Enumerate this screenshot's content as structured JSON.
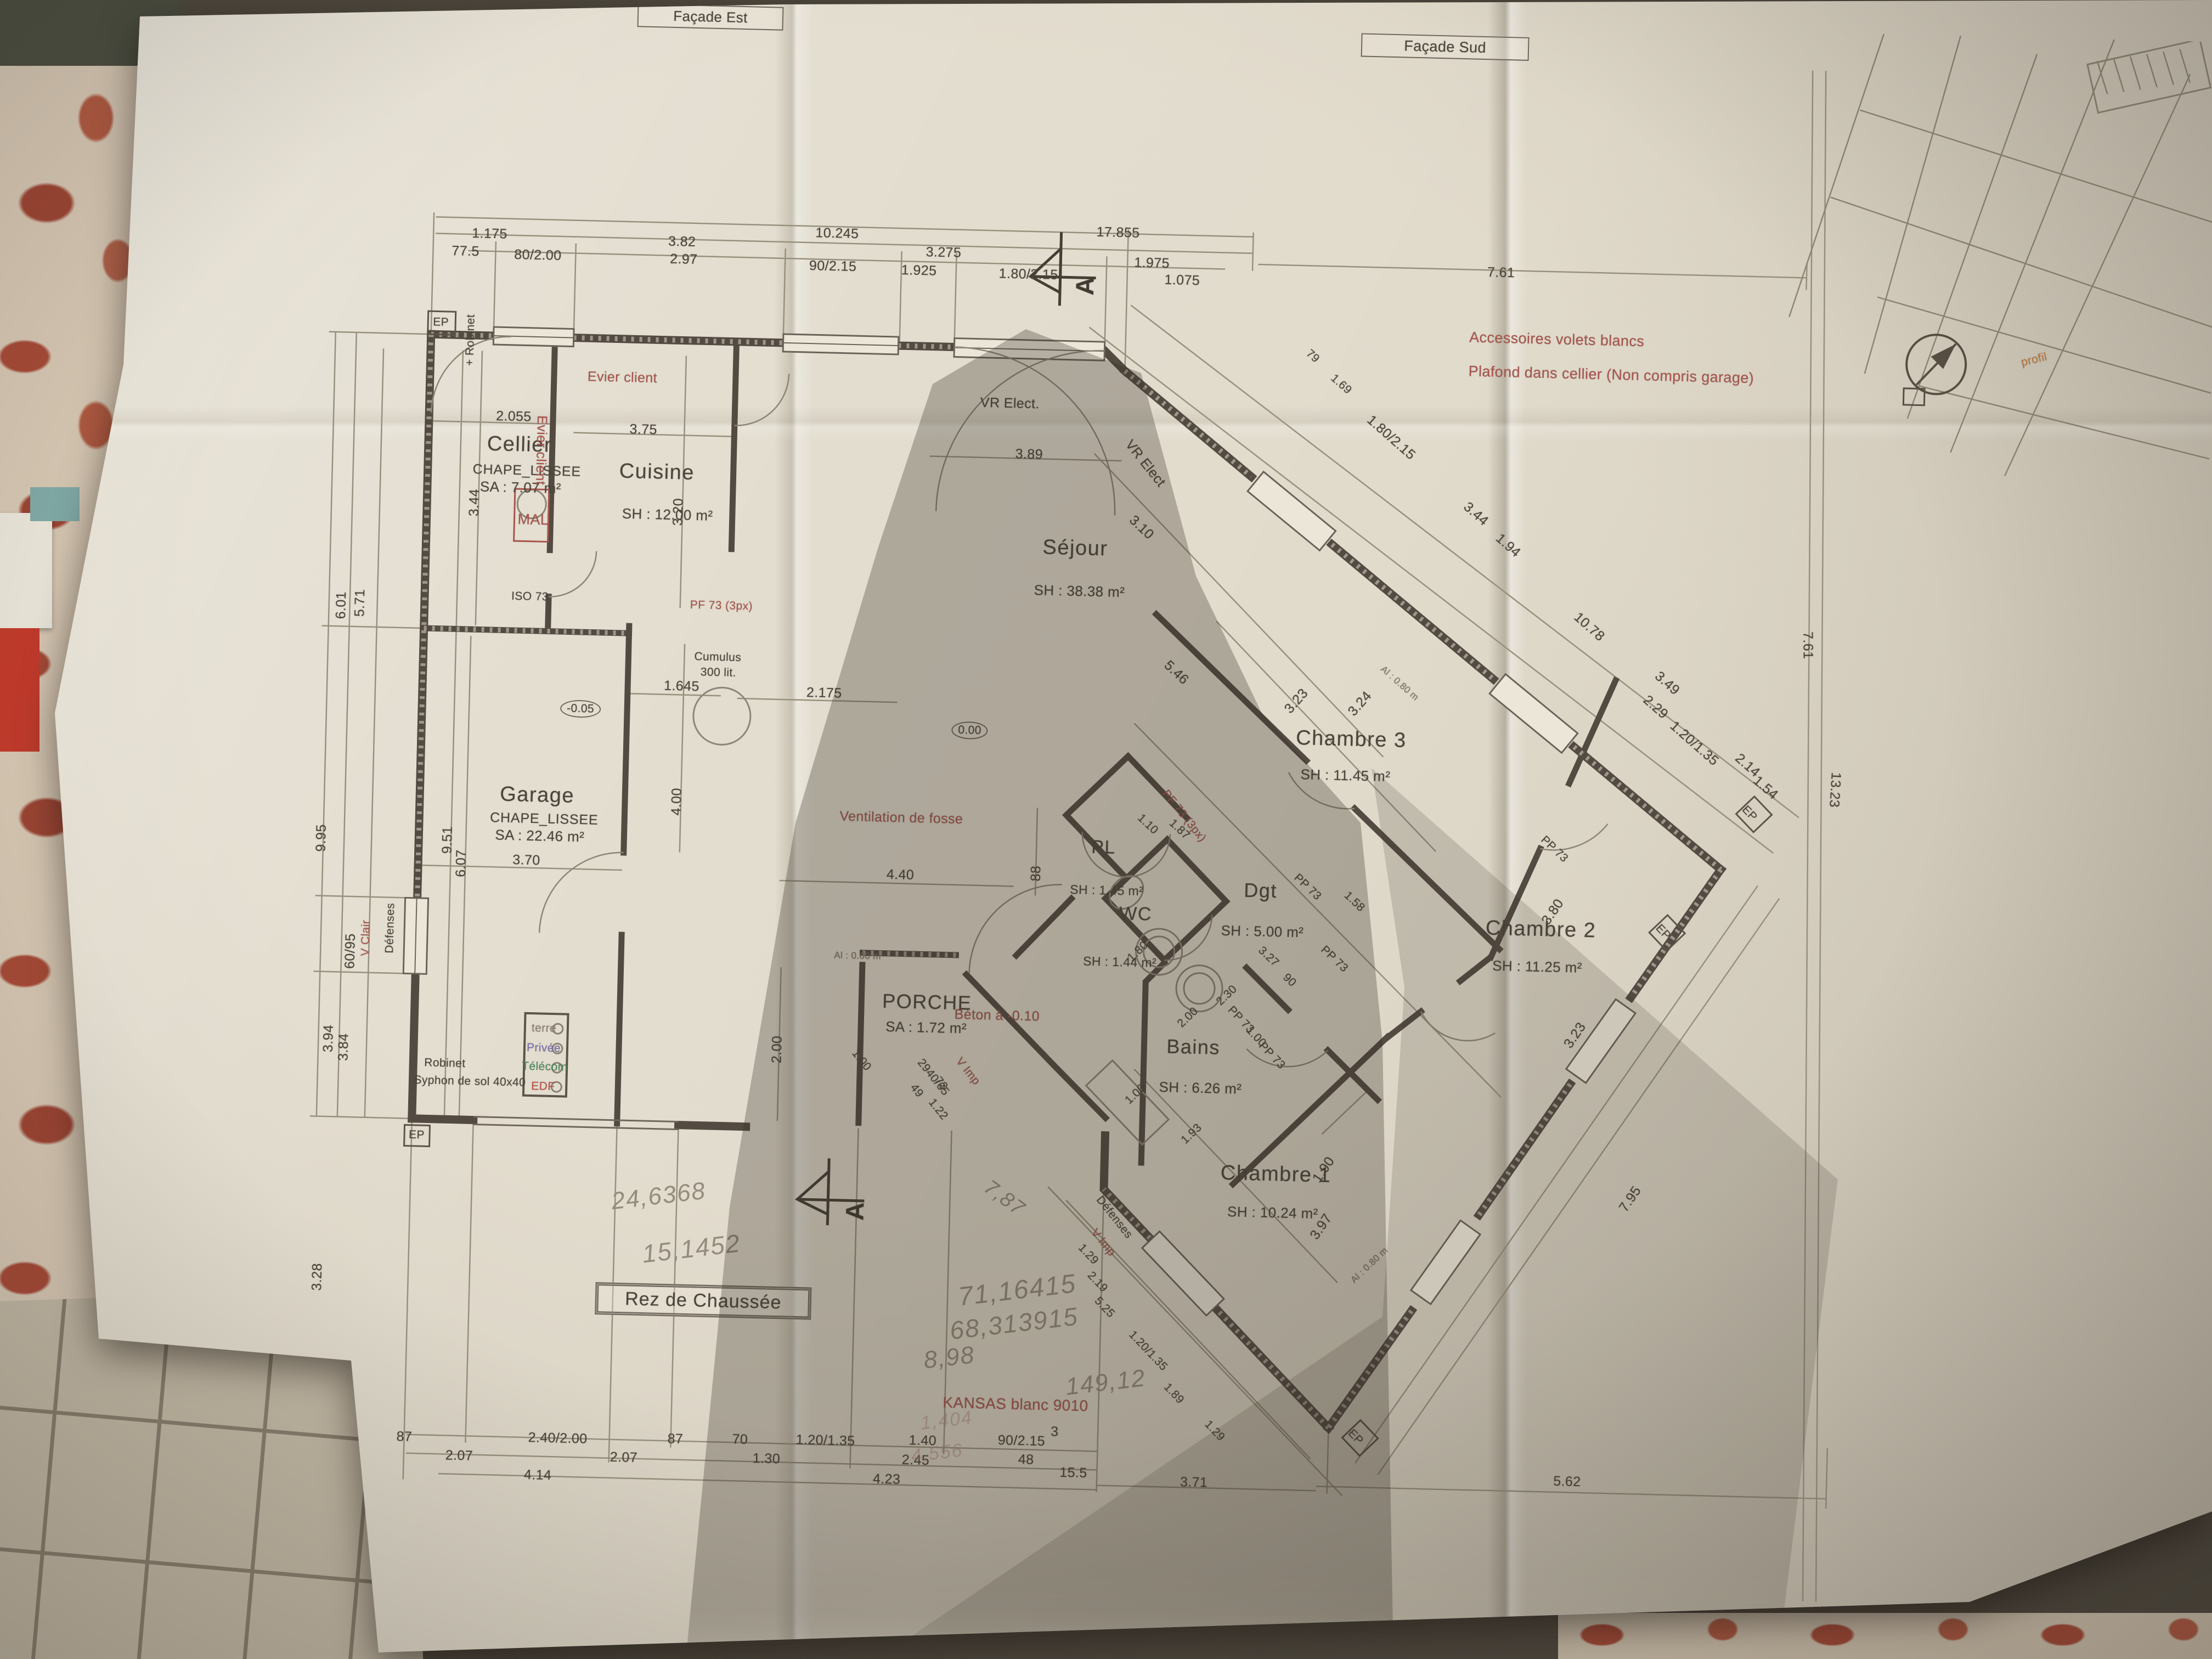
{
  "facades": {
    "est": "Façade Est",
    "sud": "Façade Sud"
  },
  "title": "Rez de Chaussée",
  "section_letter": "A",
  "rooms": {
    "cellier": {
      "name": "Cellier",
      "finish": "CHAPE_LISSEE",
      "area": "SA : 7.07 m²"
    },
    "cuisine": {
      "name": "Cuisine",
      "area": "SH : 12.00 m²"
    },
    "sejour": {
      "name": "Séjour",
      "area": "SH : 38.38 m²"
    },
    "garage": {
      "name": "Garage",
      "finish": "CHAPE_LISSEE",
      "area": "SA : 22.46 m²"
    },
    "porche": {
      "name": "PORCHE",
      "area": "SA : 1.72 m²"
    },
    "pl": {
      "name": "PL",
      "area": "SH : 1.45 m²"
    },
    "wc": {
      "name": "WC",
      "area": "SH : 1.44 m²"
    },
    "dgt": {
      "name": "Dgt",
      "area": "SH : 5.00 m²"
    },
    "bains": {
      "name": "Bains",
      "area": "SH : 6.26 m²"
    },
    "ch1": {
      "name": "Chambre 1",
      "area": "SH : 10.24 m²"
    },
    "ch2": {
      "name": "Chambre 2",
      "area": "SH : 11.25 m²"
    },
    "ch3": {
      "name": "Chambre 3",
      "area": "SH : 11.45 m²"
    }
  },
  "red_notes": {
    "evier_top": "Evier client",
    "evier_side": "Evier client",
    "vr_top": "VR Elect.",
    "vr_diag": "VR Elect",
    "accessoires": "Accessoires volets blancs",
    "plafond": "Plafond dans cellier (Non compris garage)",
    "mal": "MAL",
    "pf73_a": "PF 73 (3px)",
    "pf73_b": "PF 73 (3px)",
    "ventilation": "Ventilation de fosse",
    "beton": "Béton à -0.10",
    "v_clair": "V Clair",
    "v_imp_a": "V Imp",
    "v_imp_b": "V Imp",
    "kansas": "KANSAS blanc 9010",
    "profil": "profil"
  },
  "tech": {
    "terre": "terre",
    "privee": "Privée",
    "telecom": "Télécom",
    "edf": "EDF"
  },
  "labels": {
    "ep": "EP",
    "robinet_top": "+ Robinet",
    "robinet": "Robinet",
    "syphon": "Syphon de sol 40x40",
    "iso": "ISO 73",
    "cumulus1": "Cumulus",
    "cumulus2": "300 lit.",
    "niv0": "0.00",
    "niv005": "-0.05",
    "pp73": "PP 73",
    "defenses": "Défenses",
    "al080": "Al : 0.80 m",
    "al060": "Al : 0.60 m"
  },
  "dims": {
    "top": [
      "1.175",
      "77.5",
      "80/2.00",
      "3.82",
      "2.97",
      "10.245",
      "90/2.15",
      "3.275",
      "1.925",
      "17.855",
      "1.80/2.15",
      "1.975",
      "1.075",
      "7.61"
    ],
    "bottom": [
      "87",
      "2.40/2.00",
      "87",
      "70",
      "1.20/1.35",
      "1.40",
      "90/2.15",
      "3",
      "2.07",
      "2.07",
      "1.30",
      "2.45",
      "48",
      "15.5",
      "4.14",
      "4.23",
      "3.71",
      "5.62"
    ],
    "left": [
      "6.01",
      "5.71",
      "9.95",
      "3.94",
      "3.84",
      "3.28",
      "60/95"
    ],
    "inner": [
      "2.055",
      "3.75",
      "3.89",
      "3.44",
      "3.20",
      "9.51",
      "6.07",
      "1.645",
      "2.175",
      "-0.05",
      "0.00",
      "4.00",
      "88",
      "4.40",
      "3.70",
      "2.00",
      "1.00",
      "2940/65",
      "49",
      "73",
      "1.22"
    ],
    "ne": [
      "79",
      "1.69",
      "1.80/2.15",
      "3.44",
      "1.94",
      "10.78",
      "3.49",
      "2.29",
      "1.20/1.35",
      "2.14",
      "1.54"
    ],
    "right": [
      "7.61",
      "13.23"
    ],
    "wing": [
      "3.23",
      "3.24",
      "5.46",
      "3.10",
      "1.10",
      "1.87",
      "3.27",
      "90",
      "2.30",
      "2.00",
      "1.80",
      "1.00",
      "1.58",
      "1.93",
      "1.00",
      "1.90",
      "3.97",
      "3.80",
      "3.23",
      "7.95",
      "1.29",
      "2.19",
      "5.25",
      "1.20/1.35",
      "1.89",
      "1.29"
    ]
  },
  "handwritten": {
    "a": "24,6368",
    "b": "15,1452",
    "c": "71,16415",
    "d": "68,313915",
    "e": "8,98",
    "f": "7,87",
    "g": "149,12",
    "h": "1,404",
    "i": "4,556"
  }
}
